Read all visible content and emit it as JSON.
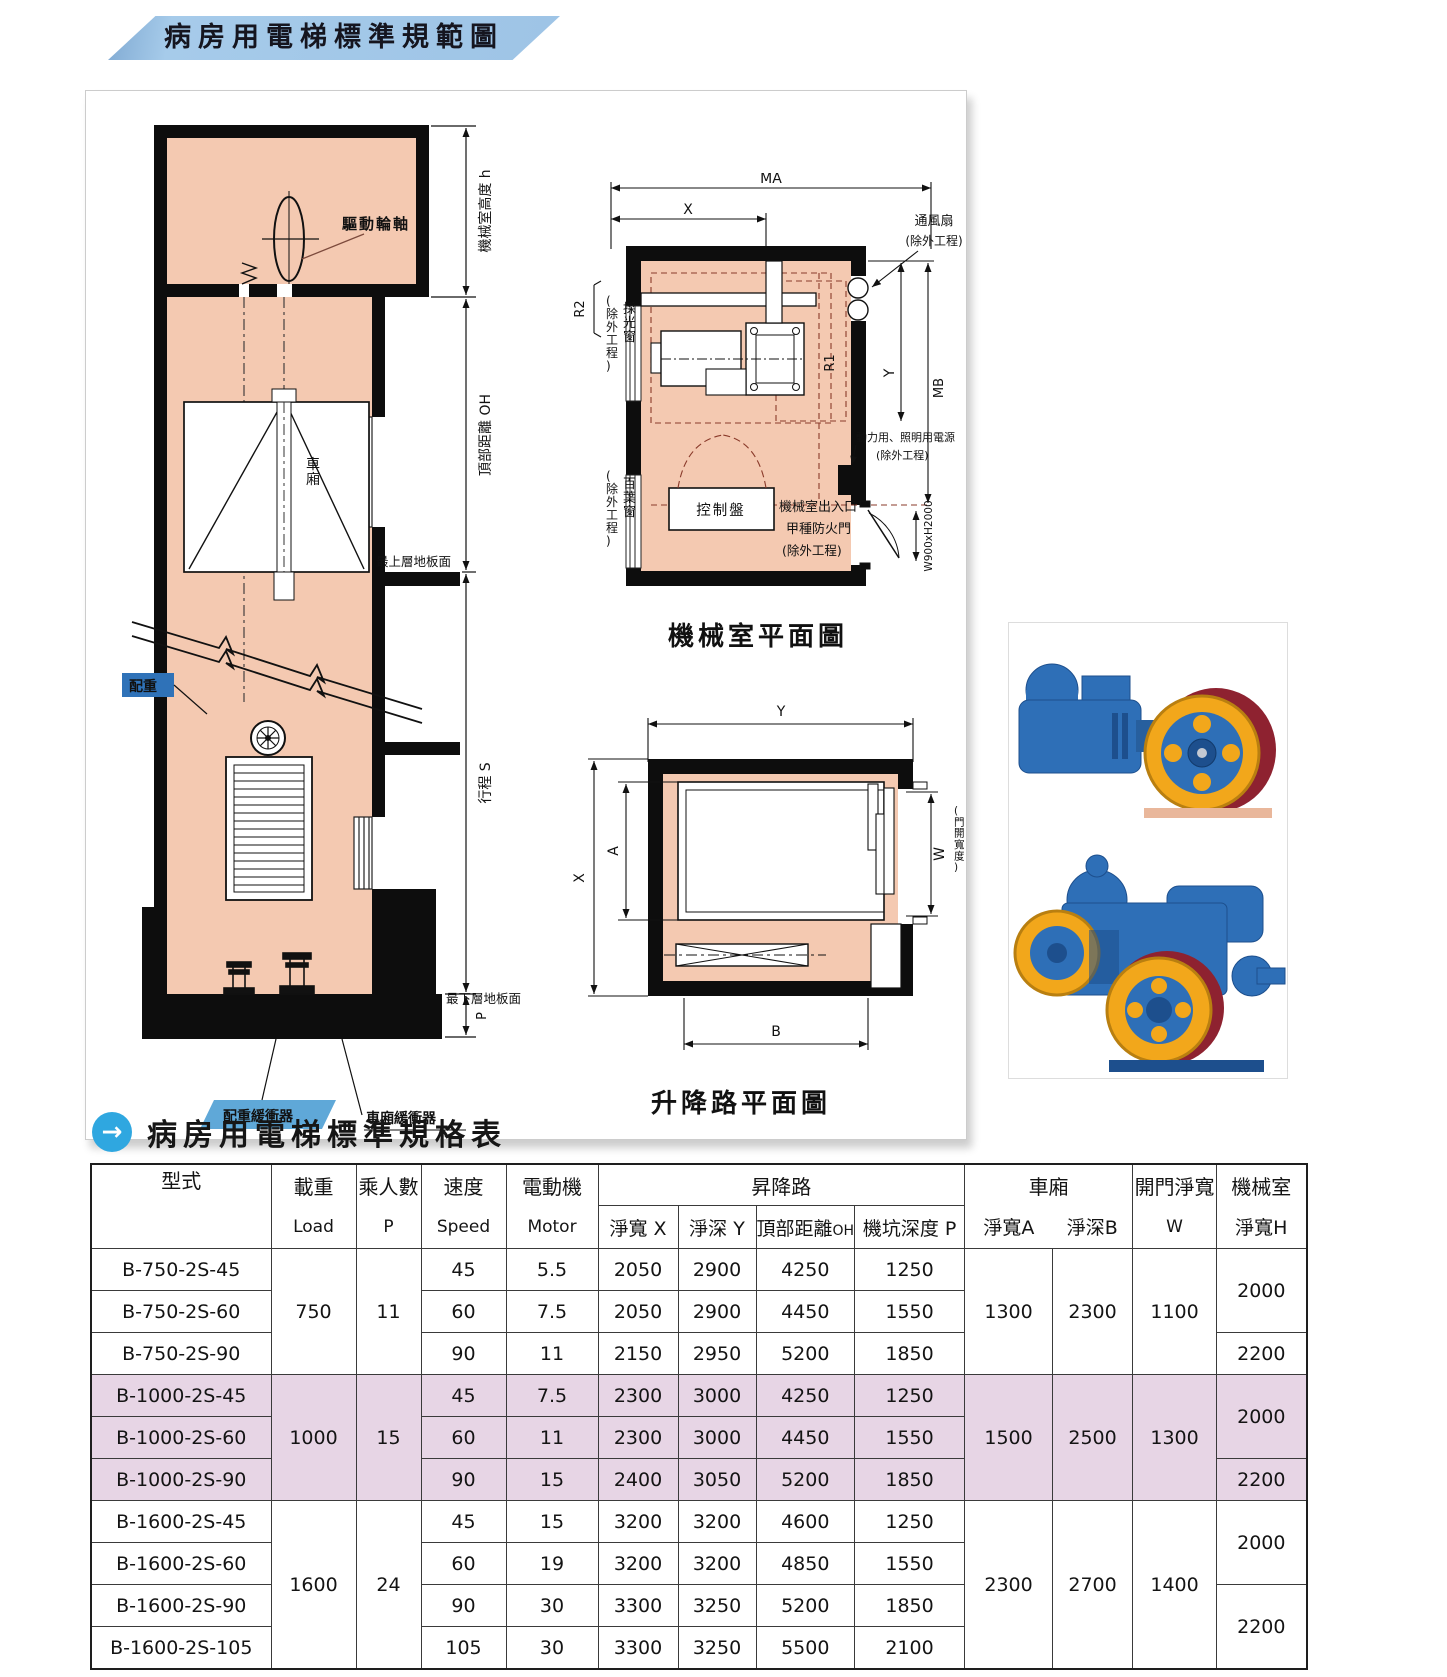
{
  "banner": {
    "title": "病房用電梯標準規範圖"
  },
  "section": {
    "title": "病房用電梯標準規格表",
    "arrow_icon": "→"
  },
  "shaft": {
    "drive_sheave": "驅動輪軸",
    "car": "車廂",
    "top_floor": "最上層地板面",
    "counterweight": "配重",
    "bottom_floor": "最下層地板面",
    "cwt_buffer": "配重緩衝器",
    "car_buffer": "車廂緩衝器",
    "dim_machine_room_height": "機械室高度 h",
    "dim_overhead": "頂部距離 OH",
    "dim_travel": "行程 S",
    "dim_pit": "P"
  },
  "machine_room": {
    "caption": "機械室平面圖",
    "ma": "MA",
    "x": "X",
    "y": "Y",
    "mb": "MB",
    "r1": "R1",
    "r2": "R2",
    "fan1": "通風扇",
    "fan2": "(除外工程)",
    "skylight1": "採光窗",
    "skylight2": "(除外工程)",
    "louver1": "百葉窗",
    "louver2": "(除外工程)",
    "power1": "動力用、照明用電源",
    "power2": "(除外工程)",
    "control_panel": "控制盤",
    "entrance1": "機械室出入口",
    "entrance2": "甲種防火門",
    "entrance3": "(除外工程)",
    "door_dim": "W900xH2000"
  },
  "hoistway": {
    "caption": "升降路平面圖",
    "y": "Y",
    "x": "X",
    "a": "A",
    "b": "B",
    "w": "W",
    "w_note": "(門開寬度)"
  },
  "table": {
    "headers": {
      "model": "型式",
      "load_zh": "載重",
      "load_en": "Load",
      "passengers_zh": "乘人數",
      "passengers_en": "P",
      "speed_zh": "速度",
      "speed_en": "Speed",
      "motor_zh": "電動機",
      "motor_en": "Motor",
      "hoistway": "昇降路",
      "hw_x": "淨寬 X",
      "hw_y": "淨深 Y",
      "hw_oh": "頂部距離",
      "hw_oh_sub": "OH",
      "hw_pit": "機坑深度 P",
      "car": "車廂",
      "car_a": "淨寬A",
      "car_b": "淨深B",
      "door_zh": "開門淨寬",
      "door_en": "W",
      "mr_zh": "機械室",
      "mr_sub": "淨寬H"
    },
    "rows": [
      [
        "B-750-2S-45",
        "750",
        "11",
        "45",
        "5.5",
        "2050",
        "2900",
        "4250",
        "1250",
        "1300",
        "2300",
        "1100",
        "2000"
      ],
      [
        "B-750-2S-60",
        "60",
        "7.5",
        "2050",
        "2900",
        "4450",
        "1550"
      ],
      [
        "B-750-2S-90",
        "90",
        "11",
        "2150",
        "2950",
        "5200",
        "1850",
        "2200"
      ],
      [
        "B-1000-2S-45",
        "1000",
        "15",
        "45",
        "7.5",
        "2300",
        "3000",
        "4250",
        "1250",
        "1500",
        "2500",
        "1300",
        "2000"
      ],
      [
        "B-1000-2S-60",
        "60",
        "11",
        "2300",
        "3000",
        "4450",
        "1550"
      ],
      [
        "B-1000-2S-90",
        "90",
        "15",
        "2400",
        "3050",
        "5200",
        "1850",
        "2200"
      ],
      [
        "B-1600-2S-45",
        "1600",
        "24",
        "45",
        "15",
        "3200",
        "3200",
        "4600",
        "1250",
        "2300",
        "2700",
        "1400",
        "2000"
      ],
      [
        "B-1600-2S-60",
        "60",
        "19",
        "3200",
        "3200",
        "4850",
        "1550"
      ],
      [
        "B-1600-2S-90",
        "90",
        "30",
        "3300",
        "3250",
        "5200",
        "1850",
        "2200"
      ],
      [
        "B-1600-2S-105",
        "105",
        "30",
        "3300",
        "3250",
        "5500",
        "2100"
      ]
    ]
  }
}
